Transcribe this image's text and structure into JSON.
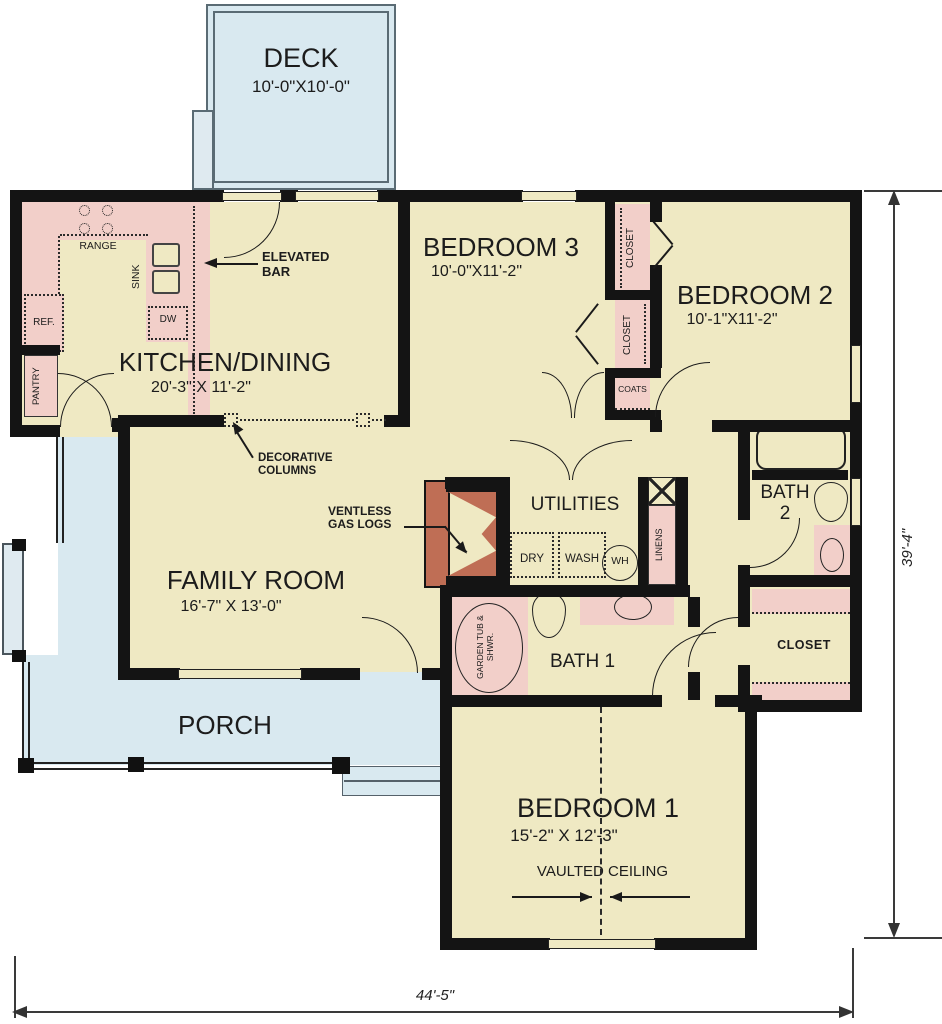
{
  "plan_title": "single-story house floor plan",
  "rooms": {
    "deck": {
      "name": "DECK",
      "dims": "10'-0\"X10'-0\""
    },
    "kitchen": {
      "name": "KITCHEN/DINING",
      "dims": "20'-3\" X 11'-2\""
    },
    "bedroom3": {
      "name": "BEDROOM 3",
      "dims": "10'-0\"X11'-2\""
    },
    "bedroom2": {
      "name": "BEDROOM 2",
      "dims": "10'-1\"X11'-2\""
    },
    "family": {
      "name": "FAMILY ROOM",
      "dims": "16'-7\" X 13'-0\""
    },
    "utilities": {
      "name": "UTILITIES"
    },
    "bath2": {
      "line1": "BATH",
      "line2": "2"
    },
    "bath1": {
      "name": "BATH 1"
    },
    "closet_master": {
      "name": "CLOSET"
    },
    "porch": {
      "name": "PORCH"
    },
    "bedroom1": {
      "name": "BEDROOM 1",
      "dims": "15'-2\" X 12'-3\"",
      "note": "VAULTED CEILING"
    }
  },
  "fixtures": {
    "range": "RANGE",
    "sink": "SINK",
    "dishwasher": "DW",
    "refrigerator": "REF.",
    "pantry": "PANTRY",
    "closet": "CLOSET",
    "coats": "COATS",
    "dryer": "DRY",
    "washer": "WASH",
    "water_heater": "WH",
    "linens": "LINENS",
    "garden_tub": "GARDEN TUB & SHWR."
  },
  "annotations": {
    "elevated_bar": "ELEVATED BAR",
    "decorative_columns": "DECORATIVE COLUMNS",
    "ventless_gas_logs": "VENTLESS GAS LOGS"
  },
  "dimensions": {
    "overall_width": "44'-5\"",
    "overall_height": "39'-4\""
  },
  "colors": {
    "floor": "#efe9c3",
    "fixture_pink": "#f2cfc9",
    "porch_blue": "#d9e9f0",
    "wall_black": "#141414",
    "fireplace_brick": "#bf6e55"
  }
}
